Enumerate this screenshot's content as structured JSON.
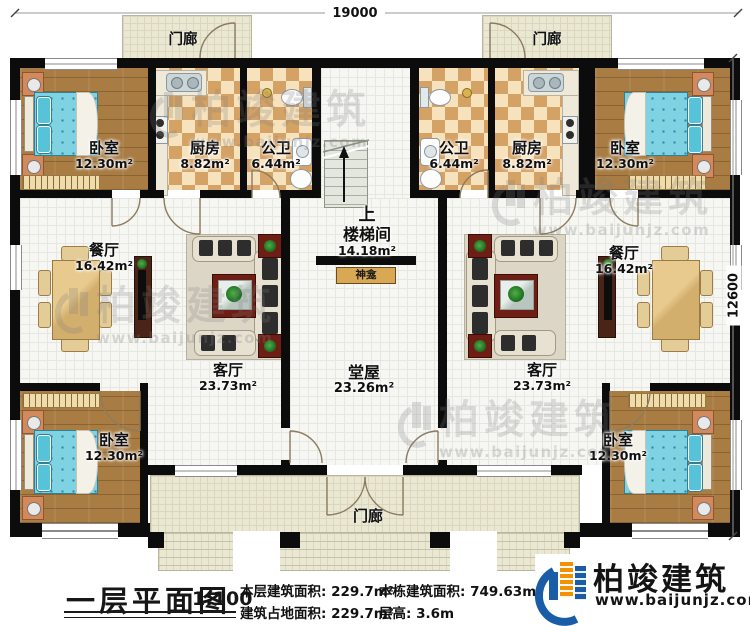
{
  "dimensions": {
    "top": "19000",
    "right": "12600"
  },
  "rooms": {
    "porch_top_left": {
      "label": "门廊"
    },
    "porch_top_right": {
      "label": "门廊"
    },
    "porch_bottom": {
      "label": "门廊"
    },
    "bedroom_tl": {
      "label": "卧室",
      "area": "12.30m²"
    },
    "bedroom_tr": {
      "label": "卧室",
      "area": "12.30m²"
    },
    "bedroom_bl": {
      "label": "卧室",
      "area": "12.30m²"
    },
    "bedroom_br": {
      "label": "卧室",
      "area": "12.30m²"
    },
    "kitchen_left": {
      "label": "厨房",
      "area": "8.82m²"
    },
    "kitchen_right": {
      "label": "厨房",
      "area": "8.82m²"
    },
    "bath_left": {
      "label": "公卫",
      "area": "6.44m²"
    },
    "bath_right": {
      "label": "公卫",
      "area": "6.44m²"
    },
    "dining_left": {
      "label": "餐厅",
      "area": "16.42m²"
    },
    "dining_right": {
      "label": "餐厅",
      "area": "16.42m²"
    },
    "living_left": {
      "label": "客厅",
      "area": "23.73m²"
    },
    "living_right": {
      "label": "客厅",
      "area": "23.73m²"
    },
    "stair_hall": {
      "label": "楼梯间",
      "area": "14.18m²",
      "direction": "上"
    },
    "main_hall": {
      "label": "堂屋",
      "area": "23.26m²"
    },
    "shrine": {
      "label": "神龛"
    }
  },
  "titleblock": {
    "title": "一层平面图",
    "scale": "1:100",
    "stats": [
      {
        "label": "本层建筑面积:",
        "value": "229.7m²"
      },
      {
        "label": "建筑占地面积:",
        "value": "229.7m²"
      },
      {
        "label": "本栋建筑面积:",
        "value": "749.63m²（包"
      },
      {
        "label": "层高:",
        "value": "3.6m"
      }
    ]
  },
  "brand": {
    "name": "柏竣建筑",
    "website": "www.baijunjz.com"
  },
  "watermark": {
    "name": "柏竣建筑",
    "website": "www.baijunjz.com"
  },
  "colors": {
    "brand_blue": "#1a5da6",
    "brand_orange": "#f39200",
    "wall": "#0c0c0c"
  }
}
